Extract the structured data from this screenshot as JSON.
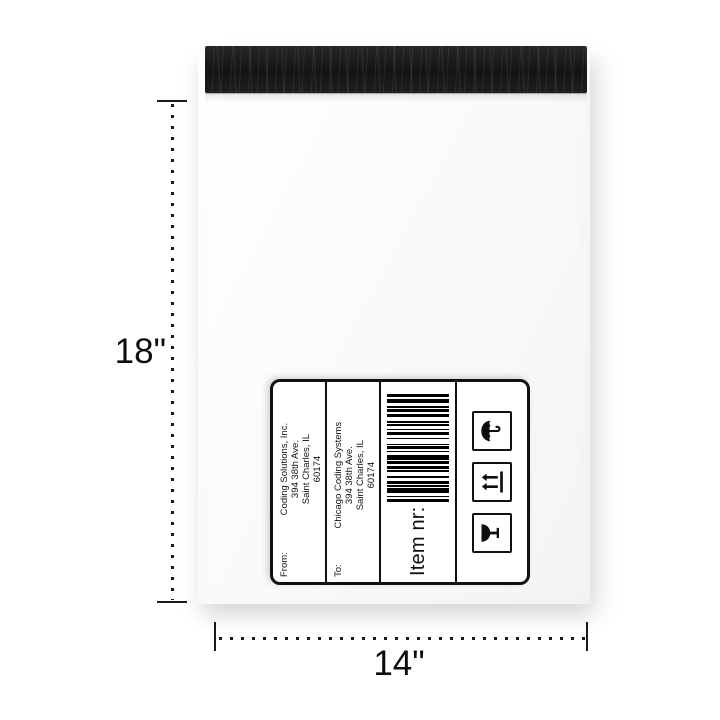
{
  "product": {
    "height_label": "18\"",
    "width_label": "14\""
  },
  "shipping_label": {
    "from": {
      "prefix": "From:",
      "lines": [
        "Coding Solutions, Inc.",
        "394 38th Ave.",
        "Saint Charles, IL",
        "60174"
      ]
    },
    "to": {
      "prefix": "To:",
      "lines": [
        "Chicago Coding Systems",
        "394 38th Ave.",
        "Saint Charles, IL",
        "60174"
      ]
    },
    "item_field_label": "Item nr:",
    "barcode": {
      "bars": [
        2,
        1,
        1,
        2,
        3,
        1,
        1,
        1,
        2,
        2,
        1,
        3,
        1,
        1,
        2,
        1,
        2,
        1,
        3,
        2,
        1,
        1,
        2,
        1,
        1,
        3,
        1,
        2,
        2,
        1,
        1,
        2,
        1,
        1,
        1,
        3,
        2,
        1,
        2,
        1,
        1,
        2,
        3,
        1,
        2
      ]
    },
    "handling_icons": [
      "fragile-glass",
      "this-way-up",
      "keep-dry-umbrella"
    ]
  },
  "colors": {
    "flap": "#1d1d1d",
    "ink": "#111111",
    "dim_line": "#1a1a1a",
    "barcode_bar": "#000000"
  }
}
